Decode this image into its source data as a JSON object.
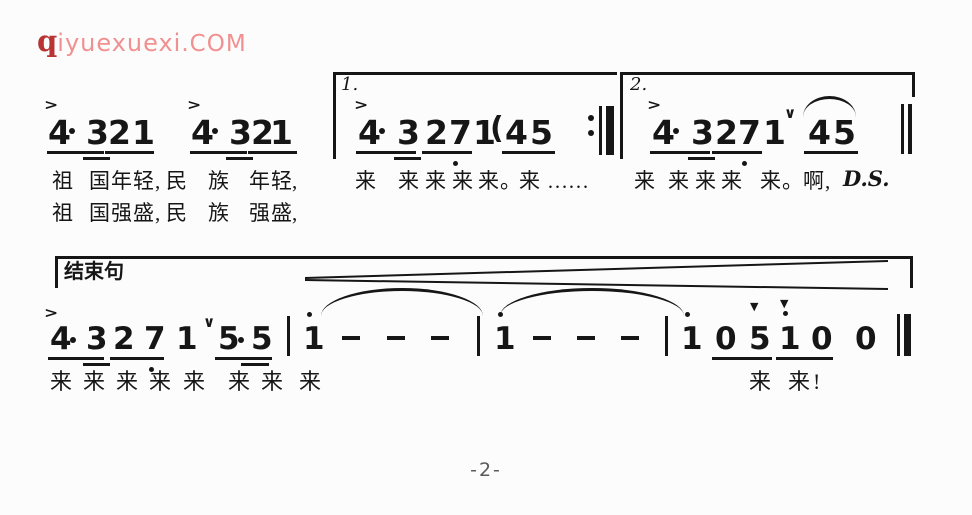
{
  "page": {
    "page_number": "-2-"
  },
  "logo": {
    "q": "q",
    "name": "iyuexuexi",
    "tld": ".COM",
    "q_color": "#b93434",
    "text_color": "#f19090"
  },
  "transcription": {
    "line1": "4·3 2 1 4·3 2 1 | [1.] 4·3 2 7. 1 (4 5 :|| [2.] 4·3 2 7. 1 ∨ 4~5 || D.S.",
    "line2": "[结束句] 4·3 2 7. 1 ∨ 5·5 | 1' - - - | 1' - - - | 1' 0 5 1' 0 0 ||",
    "lyrics1": "祖 国年轻,民 族 年轻, 来 来来来来。来…… 来 来来来 来。啊,",
    "lyrics2": "祖 国强盛,民 族 强盛,",
    "lyrics3": "来来来来来 来来 来 来来!"
  },
  "score": {
    "glyphs": [
      {
        "n": "accent-icon",
        "c": "acc",
        "t": ">",
        "x": 44,
        "y": 97
      },
      {
        "n": "accent-icon",
        "c": "acc",
        "t": ">",
        "x": 187,
        "y": 97
      },
      {
        "n": "accent-icon",
        "c": "acc",
        "t": ">",
        "x": 354,
        "y": 97
      },
      {
        "n": "accent-icon",
        "c": "acc",
        "t": ">",
        "x": 647,
        "y": 97
      },
      {
        "n": "note",
        "c": "n1",
        "t": "4",
        "x": 48,
        "y": 116
      },
      {
        "n": "note",
        "c": "n1",
        "t": "3",
        "x": 86,
        "y": 116
      },
      {
        "n": "note",
        "c": "n1",
        "t": "2",
        "x": 108,
        "y": 116
      },
      {
        "n": "note",
        "c": "n1",
        "t": "1",
        "x": 132,
        "y": 116
      },
      {
        "n": "note",
        "c": "n1",
        "t": "4",
        "x": 191,
        "y": 116
      },
      {
        "n": "note",
        "c": "n1",
        "t": "3",
        "x": 229,
        "y": 116
      },
      {
        "n": "note",
        "c": "n1",
        "t": "2",
        "x": 251,
        "y": 116
      },
      {
        "n": "note",
        "c": "n1",
        "t": "1",
        "x": 270,
        "y": 116
      },
      {
        "n": "volta1-label",
        "c": "vl",
        "t": "1.",
        "x": 341,
        "y": 76
      },
      {
        "n": "note",
        "c": "n1",
        "t": "4",
        "x": 358,
        "y": 116
      },
      {
        "n": "note",
        "c": "n1",
        "t": "3",
        "x": 397,
        "y": 116
      },
      {
        "n": "note",
        "c": "n1",
        "t": "2",
        "x": 425,
        "y": 116
      },
      {
        "n": "note",
        "c": "n1",
        "t": "7",
        "x": 449,
        "y": 116
      },
      {
        "n": "note",
        "c": "n1",
        "t": "1",
        "x": 473,
        "y": 116
      },
      {
        "n": "paren-open",
        "c": "n1",
        "t": "(",
        "x": 490,
        "y": 114,
        "fs": 30
      },
      {
        "n": "note",
        "c": "n1",
        "t": "4",
        "x": 505,
        "y": 116
      },
      {
        "n": "note",
        "c": "n1",
        "t": "5",
        "x": 530,
        "y": 116
      },
      {
        "n": "volta2-label",
        "c": "vl",
        "t": "2.",
        "x": 630,
        "y": 76
      },
      {
        "n": "note",
        "c": "n1",
        "t": "4",
        "x": 652,
        "y": 116
      },
      {
        "n": "note",
        "c": "n1",
        "t": "3",
        "x": 691,
        "y": 116
      },
      {
        "n": "note",
        "c": "n1",
        "t": "2",
        "x": 715,
        "y": 116
      },
      {
        "n": "note",
        "c": "n1",
        "t": "7",
        "x": 738,
        "y": 116
      },
      {
        "n": "note",
        "c": "n1",
        "t": "1",
        "x": 763,
        "y": 116
      },
      {
        "n": "breath-mark-icon",
        "c": "br",
        "t": "∨",
        "x": 784,
        "y": 106
      },
      {
        "n": "note",
        "c": "n1",
        "t": "4",
        "x": 808,
        "y": 116
      },
      {
        "n": "note",
        "c": "n1",
        "t": "5",
        "x": 833,
        "y": 116
      },
      {
        "n": "ds-label",
        "c": "ds",
        "t": "D.S.",
        "x": 843,
        "y": 168
      },
      {
        "n": "ending-phrase-label",
        "c": "el",
        "t": "结束句",
        "x": 64,
        "y": 262
      },
      {
        "n": "accent-icon",
        "c": "acc",
        "t": ">",
        "x": 44,
        "y": 305
      },
      {
        "n": "note",
        "c": "n2",
        "t": "4",
        "x": 50,
        "y": 324
      },
      {
        "n": "note",
        "c": "n2",
        "t": "3",
        "x": 86,
        "y": 324
      },
      {
        "n": "note",
        "c": "n2",
        "t": "2",
        "x": 113,
        "y": 324
      },
      {
        "n": "note",
        "c": "n2",
        "t": "7",
        "x": 144,
        "y": 324
      },
      {
        "n": "note",
        "c": "n2",
        "t": "1",
        "x": 176,
        "y": 324
      },
      {
        "n": "breath-mark-icon",
        "c": "br",
        "t": "∨",
        "x": 203,
        "y": 315
      },
      {
        "n": "note",
        "c": "n2",
        "t": "5",
        "x": 218,
        "y": 324
      },
      {
        "n": "note",
        "c": "n2",
        "t": "5",
        "x": 251,
        "y": 324
      },
      {
        "n": "note",
        "c": "n2",
        "t": "1",
        "x": 303,
        "y": 324
      },
      {
        "n": "note",
        "c": "n2",
        "t": "1",
        "x": 494,
        "y": 324
      },
      {
        "n": "note",
        "c": "n2",
        "t": "1",
        "x": 681,
        "y": 324
      },
      {
        "n": "note",
        "c": "n2",
        "t": "0",
        "x": 715,
        "y": 324
      },
      {
        "n": "wedge-accent-icon",
        "c": "wg",
        "t": "▼",
        "x": 750,
        "y": 301
      },
      {
        "n": "note",
        "c": "n2",
        "t": "5",
        "x": 749,
        "y": 324
      },
      {
        "n": "wedge-accent-icon",
        "c": "wg",
        "t": "▼",
        "x": 780,
        "y": 298
      },
      {
        "n": "note",
        "c": "n2",
        "t": "1",
        "x": 779,
        "y": 324
      },
      {
        "n": "note",
        "c": "n2",
        "t": "0",
        "x": 811,
        "y": 324
      },
      {
        "n": "note",
        "c": "n2",
        "t": "0",
        "x": 855,
        "y": 324
      },
      {
        "n": "lyric",
        "c": "ly",
        "t": "祖",
        "x": 52,
        "y": 171
      },
      {
        "n": "lyric",
        "c": "ly",
        "t": "国",
        "x": 89,
        "y": 171
      },
      {
        "n": "lyric",
        "c": "ly",
        "t": "年",
        "x": 111,
        "y": 171
      },
      {
        "n": "lyric",
        "c": "ly",
        "t": "轻",
        "x": 133,
        "y": 171
      },
      {
        "n": "lyric",
        "c": "ly",
        "t": ",",
        "x": 155,
        "y": 171
      },
      {
        "n": "lyric",
        "c": "ly",
        "t": "民",
        "x": 166,
        "y": 171
      },
      {
        "n": "lyric",
        "c": "ly",
        "t": "族",
        "x": 208,
        "y": 171
      },
      {
        "n": "lyric",
        "c": "ly",
        "t": "年",
        "x": 249,
        "y": 171
      },
      {
        "n": "lyric",
        "c": "ly",
        "t": "轻",
        "x": 271,
        "y": 171
      },
      {
        "n": "lyric",
        "c": "ly",
        "t": ",",
        "x": 292,
        "y": 171
      },
      {
        "n": "lyric",
        "c": "ly",
        "t": "来",
        "x": 355,
        "y": 171
      },
      {
        "n": "lyric",
        "c": "ly",
        "t": "来",
        "x": 398,
        "y": 171
      },
      {
        "n": "lyric",
        "c": "ly",
        "t": "来",
        "x": 425,
        "y": 171
      },
      {
        "n": "lyric",
        "c": "ly",
        "t": "来",
        "x": 452,
        "y": 171
      },
      {
        "n": "lyric",
        "c": "ly",
        "t": "来",
        "x": 478,
        "y": 171
      },
      {
        "n": "lyric",
        "c": "ly",
        "t": "。",
        "x": 500,
        "y": 171
      },
      {
        "n": "lyric",
        "c": "ly",
        "t": "来",
        "x": 519,
        "y": 171
      },
      {
        "n": "lyric",
        "c": "ly",
        "t": "……",
        "x": 547,
        "y": 171
      },
      {
        "n": "lyric",
        "c": "ly",
        "t": "来",
        "x": 634,
        "y": 171
      },
      {
        "n": "lyric",
        "c": "ly",
        "t": "来",
        "x": 668,
        "y": 171
      },
      {
        "n": "lyric",
        "c": "ly",
        "t": "来",
        "x": 695,
        "y": 171
      },
      {
        "n": "lyric",
        "c": "ly",
        "t": "来",
        "x": 721,
        "y": 171
      },
      {
        "n": "lyric",
        "c": "ly",
        "t": "来",
        "x": 760,
        "y": 171
      },
      {
        "n": "lyric",
        "c": "ly",
        "t": "。",
        "x": 782,
        "y": 171
      },
      {
        "n": "lyric",
        "c": "ly",
        "t": "啊",
        "x": 803,
        "y": 171
      },
      {
        "n": "lyric",
        "c": "ly",
        "t": ",",
        "x": 825,
        "y": 171
      },
      {
        "n": "lyric",
        "c": "ly",
        "t": "祖",
        "x": 52,
        "y": 203
      },
      {
        "n": "lyric",
        "c": "ly",
        "t": "国",
        "x": 89,
        "y": 203
      },
      {
        "n": "lyric",
        "c": "ly",
        "t": "强",
        "x": 111,
        "y": 203
      },
      {
        "n": "lyric",
        "c": "ly",
        "t": "盛",
        "x": 133,
        "y": 203
      },
      {
        "n": "lyric",
        "c": "ly",
        "t": ",",
        "x": 155,
        "y": 203
      },
      {
        "n": "lyric",
        "c": "ly",
        "t": "民",
        "x": 166,
        "y": 203
      },
      {
        "n": "lyric",
        "c": "ly",
        "t": "族",
        "x": 208,
        "y": 203
      },
      {
        "n": "lyric",
        "c": "ly",
        "t": "强",
        "x": 249,
        "y": 203
      },
      {
        "n": "lyric",
        "c": "ly",
        "t": "盛",
        "x": 271,
        "y": 203
      },
      {
        "n": "lyric",
        "c": "ly",
        "t": ",",
        "x": 292,
        "y": 203
      },
      {
        "n": "lyric",
        "c": "ly",
        "t": "来",
        "x": 50,
        "y": 371,
        "fs": 22
      },
      {
        "n": "lyric",
        "c": "ly",
        "t": "来",
        "x": 83,
        "y": 371,
        "fs": 22
      },
      {
        "n": "lyric",
        "c": "ly",
        "t": "来",
        "x": 116,
        "y": 371,
        "fs": 22
      },
      {
        "n": "lyric",
        "c": "ly",
        "t": "来",
        "x": 149,
        "y": 371,
        "fs": 22
      },
      {
        "n": "lyric",
        "c": "ly",
        "t": "来",
        "x": 183,
        "y": 371,
        "fs": 22
      },
      {
        "n": "lyric",
        "c": "ly",
        "t": "来",
        "x": 228,
        "y": 371,
        "fs": 22
      },
      {
        "n": "lyric",
        "c": "ly",
        "t": "来",
        "x": 261,
        "y": 371,
        "fs": 22
      },
      {
        "n": "lyric",
        "c": "ly",
        "t": "来",
        "x": 299,
        "y": 371,
        "fs": 22
      },
      {
        "n": "lyric",
        "c": "ly",
        "t": "来",
        "x": 749,
        "y": 371,
        "fs": 22
      },
      {
        "n": "lyric",
        "c": "ly",
        "t": "来",
        "x": 788,
        "y": 371,
        "fs": 22
      },
      {
        "n": "lyric",
        "c": "ly",
        "t": "!",
        "x": 813,
        "y": 371,
        "fs": 22
      }
    ],
    "rects": [
      {
        "n": "volta1-top-line",
        "x": 333,
        "y": 72,
        "w": 284,
        "h": 3
      },
      {
        "n": "volta1-left-line",
        "x": 333,
        "y": 72,
        "w": 3,
        "h": 87
      },
      {
        "n": "volta2-top-line",
        "x": 620,
        "y": 72,
        "w": 295,
        "h": 3
      },
      {
        "n": "volta2-left-line",
        "x": 620,
        "y": 72,
        "w": 3,
        "h": 87
      },
      {
        "n": "volta2-right-stub",
        "x": 912,
        "y": 72,
        "w": 3,
        "h": 25
      },
      {
        "n": "repeat-barline-thin",
        "x": 599,
        "y": 106,
        "w": 3,
        "h": 49
      },
      {
        "n": "repeat-barline-thick",
        "x": 606,
        "y": 106,
        "w": 8,
        "h": 49
      },
      {
        "n": "final-barline",
        "x": 901,
        "y": 104,
        "w": 3,
        "h": 50
      },
      {
        "n": "final-barline",
        "x": 908,
        "y": 104,
        "w": 4,
        "h": 50
      },
      {
        "n": "underline",
        "x": 47,
        "y": 151,
        "w": 57,
        "h": 3
      },
      {
        "n": "beam2",
        "x": 83,
        "y": 157,
        "w": 27,
        "h": 3
      },
      {
        "n": "underline",
        "x": 105,
        "y": 151,
        "w": 49,
        "h": 3
      },
      {
        "n": "underline",
        "x": 190,
        "y": 151,
        "w": 57,
        "h": 3
      },
      {
        "n": "beam2",
        "x": 226,
        "y": 157,
        "w": 27,
        "h": 3
      },
      {
        "n": "underline",
        "x": 248,
        "y": 151,
        "w": 49,
        "h": 3
      },
      {
        "n": "underline",
        "x": 356,
        "y": 151,
        "w": 60,
        "h": 3
      },
      {
        "n": "beam2",
        "x": 394,
        "y": 157,
        "w": 27,
        "h": 3
      },
      {
        "n": "underline",
        "x": 422,
        "y": 151,
        "w": 50,
        "h": 3
      },
      {
        "n": "underline",
        "x": 502,
        "y": 151,
        "w": 53,
        "h": 3
      },
      {
        "n": "underline",
        "x": 650,
        "y": 151,
        "w": 60,
        "h": 3
      },
      {
        "n": "beam2",
        "x": 688,
        "y": 157,
        "w": 27,
        "h": 3
      },
      {
        "n": "underline",
        "x": 712,
        "y": 151,
        "w": 50,
        "h": 3
      },
      {
        "n": "underline",
        "x": 804,
        "y": 151,
        "w": 54,
        "h": 3
      },
      {
        "n": "duration-dot",
        "x": 69,
        "y": 128,
        "w": 6,
        "h": 6,
        "r": 1
      },
      {
        "n": "duration-dot",
        "x": 212,
        "y": 128,
        "w": 6,
        "h": 6,
        "r": 1
      },
      {
        "n": "duration-dot",
        "x": 379,
        "y": 128,
        "w": 6,
        "h": 6,
        "r": 1
      },
      {
        "n": "duration-dot",
        "x": 673,
        "y": 128,
        "w": 6,
        "h": 6,
        "r": 1
      },
      {
        "n": "octave-dot-low",
        "x": 453,
        "y": 161,
        "w": 5,
        "h": 5,
        "r": 1
      },
      {
        "n": "octave-dot-low",
        "x": 742,
        "y": 161,
        "w": 5,
        "h": 5,
        "r": 1
      },
      {
        "n": "repeat-dot",
        "x": 588,
        "y": 115,
        "w": 6,
        "h": 6,
        "r": 1
      },
      {
        "n": "repeat-dot",
        "x": 588,
        "y": 130,
        "w": 6,
        "h": 6,
        "r": 1
      },
      {
        "n": "system2-top-line",
        "x": 55,
        "y": 256,
        "w": 858,
        "h": 3
      },
      {
        "n": "system2-left-stub",
        "x": 55,
        "y": 256,
        "w": 3,
        "h": 32
      },
      {
        "n": "system2-right-stub",
        "x": 910,
        "y": 256,
        "w": 3,
        "h": 32
      },
      {
        "n": "barline",
        "x": 287,
        "y": 316,
        "w": 3,
        "h": 40
      },
      {
        "n": "barline",
        "x": 477,
        "y": 316,
        "w": 3,
        "h": 40
      },
      {
        "n": "barline",
        "x": 665,
        "y": 316,
        "w": 3,
        "h": 40
      },
      {
        "n": "final-barline",
        "x": 897,
        "y": 314,
        "w": 3,
        "h": 42
      },
      {
        "n": "final-barline",
        "x": 904,
        "y": 314,
        "w": 7,
        "h": 42
      },
      {
        "n": "underline",
        "x": 48,
        "y": 357,
        "w": 56,
        "h": 3
      },
      {
        "n": "beam2",
        "x": 83,
        "y": 363,
        "w": 27,
        "h": 3
      },
      {
        "n": "underline",
        "x": 110,
        "y": 357,
        "w": 54,
        "h": 3
      },
      {
        "n": "underline",
        "x": 215,
        "y": 357,
        "w": 57,
        "h": 3
      },
      {
        "n": "beam2",
        "x": 241,
        "y": 363,
        "w": 28,
        "h": 3
      },
      {
        "n": "underline",
        "x": 712,
        "y": 357,
        "w": 60,
        "h": 3
      },
      {
        "n": "underline",
        "x": 776,
        "y": 357,
        "w": 57,
        "h": 3
      },
      {
        "n": "duration-dot",
        "x": 70,
        "y": 337,
        "w": 6,
        "h": 6,
        "r": 1
      },
      {
        "n": "duration-dot",
        "x": 238,
        "y": 337,
        "w": 6,
        "h": 6,
        "r": 1
      },
      {
        "n": "octave-dot-low",
        "x": 149,
        "y": 367,
        "w": 5,
        "h": 5,
        "r": 1
      },
      {
        "n": "octave-dot-high",
        "x": 307,
        "y": 312,
        "w": 5,
        "h": 5,
        "r": 1
      },
      {
        "n": "octave-dot-high",
        "x": 498,
        "y": 312,
        "w": 5,
        "h": 5,
        "r": 1
      },
      {
        "n": "octave-dot-high",
        "x": 685,
        "y": 312,
        "w": 5,
        "h": 5,
        "r": 1
      },
      {
        "n": "octave-dot-high",
        "x": 783,
        "y": 311,
        "w": 5,
        "h": 5,
        "r": 1
      },
      {
        "n": "dash-rest",
        "x": 342,
        "y": 336,
        "w": 18,
        "h": 4
      },
      {
        "n": "dash-rest",
        "x": 387,
        "y": 336,
        "w": 18,
        "h": 4
      },
      {
        "n": "dash-rest",
        "x": 431,
        "y": 336,
        "w": 18,
        "h": 4
      },
      {
        "n": "dash-rest",
        "x": 533,
        "y": 336,
        "w": 18,
        "h": 4
      },
      {
        "n": "dash-rest",
        "x": 577,
        "y": 336,
        "w": 18,
        "h": 4
      },
      {
        "n": "dash-rest",
        "x": 621,
        "y": 336,
        "w": 18,
        "h": 4
      }
    ],
    "arcs": [
      {
        "n": "slur-arc",
        "x": 803,
        "y": 96,
        "w": 53,
        "h": 18
      },
      {
        "n": "tie-arc",
        "x": 321,
        "y": 288,
        "w": 162,
        "h": 25
      },
      {
        "n": "tie-arc",
        "x": 500,
        "y": 288,
        "w": 184,
        "h": 25
      }
    ],
    "cresc": [
      {
        "x1": 305,
        "y1": 278,
        "x2": 888,
        "y2": 261
      },
      {
        "x1": 305,
        "y1": 280,
        "x2": 888,
        "y2": 289
      }
    ],
    "ink": "#161616"
  }
}
